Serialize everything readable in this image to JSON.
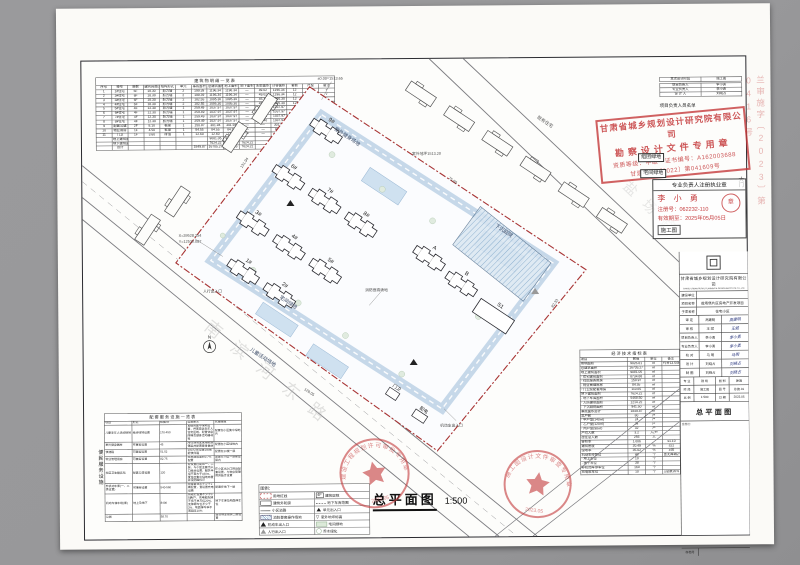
{
  "drawing_title": {
    "name": "总平面图",
    "scale": "1:500"
  },
  "sheet": {
    "margin_stamp": "兰审施字〔2023〕第0416号",
    "gate_label": "大门",
    "box_label_1": "组团绿地",
    "box_label_2": "宅间绿地",
    "fac_category": "便民服务设施",
    "pers_note": "项目负责人员名单",
    "blank_note": "会签栏："
  },
  "buildings_table": {
    "title": "建筑物明细一览表",
    "headers": [
      [
        "序号",
        "楼号",
        "层数",
        "建筑高度(m)",
        "结构形式",
        "单元",
        "基底面积",
        "总建筑面积",
        "地上面积",
        "地下面积",
        "阳台面积",
        "计容面积",
        "套数",
        "户型",
        "备注"
      ]
    ],
    "rows": [
      [
        "1",
        "1#住宅",
        "6F",
        "18.30",
        "剪力墙",
        "2",
        "199.39",
        "1196.34",
        "1196.34",
        "—",
        "49.02",
        "1196.34",
        "12",
        "甲",
        "√"
      ],
      [
        "2",
        "2#住宅",
        "6F",
        "18.30",
        "剪力墙",
        "2",
        "199.39",
        "1196.34",
        "1196.34",
        "—",
        "49.02",
        "1196.34",
        "12",
        "甲",
        "√"
      ],
      [
        "3",
        "3#住宅",
        "6F",
        "18.30",
        "剪力墙",
        "2",
        "182.55",
        "1095.30",
        "1095.30",
        "—",
        "45.15",
        "1095.30",
        "12",
        "乙",
        "√"
      ],
      [
        "4",
        "4#住宅",
        "6F",
        "18.30",
        "剪力墙",
        "2",
        "182.55",
        "1095.30",
        "1095.30",
        "—",
        "45.15",
        "1095.30",
        "12",
        "乙",
        "√"
      ],
      [
        "5",
        "5#住宅",
        "4F",
        "12.30",
        "剪力墙",
        "1",
        "259.49",
        "1037.97",
        "1037.97",
        "—",
        "32.40",
        "1037.97",
        "8",
        "丙",
        "√"
      ],
      [
        "6",
        "6#住宅",
        "4F",
        "12.30",
        "剪力墙",
        "1",
        "259.49",
        "1037.97",
        "1037.97",
        "—",
        "32.40",
        "1037.97",
        "8",
        "丙",
        "√"
      ],
      [
        "7",
        "7#住宅",
        "4F",
        "12.30",
        "剪力墙",
        "1",
        "259.49",
        "1037.97",
        "1037.97",
        "—",
        "32.40",
        "1037.97",
        "8",
        "丙",
        "√"
      ],
      [
        "8",
        "8#住宅",
        "4F",
        "12.30",
        "剪力墙",
        "1",
        "259.49",
        "1037.97",
        "1037.97",
        "—",
        "32.40",
        "1037.97",
        "8",
        "丙",
        "√"
      ],
      [
        "9",
        "配套公建",
        "2F",
        "8.10",
        "框架",
        "1",
        "150.97",
        "301.94",
        "301.94",
        "—",
        "—",
        "301.94",
        "—",
        "—",
        "√"
      ],
      [
        "10",
        "物业用房",
        "1F",
        "4.50",
        "框架",
        "1",
        "84.55",
        "84.55",
        "84.55",
        "—",
        "—",
        "84.55",
        "—",
        "—",
        "√"
      ],
      [
        "11",
        "门卫",
        "1F",
        "3.60",
        "砖混",
        "1",
        "12.60",
        "12.60",
        "12.60",
        "—",
        "—",
        "12.60",
        "—",
        "—",
        "√"
      ],
      [
        "",
        "地上建筑面积小计",
        "",
        "",
        "",
        "",
        "",
        "9081.05",
        "9081.05",
        "",
        "",
        "",
        "",
        "",
        ""
      ],
      [
        "",
        "地下建筑面积",
        "",
        "",
        "",
        "",
        "",
        "7624.22",
        "",
        "7624.22",
        "",
        "",
        "",
        "",
        ""
      ],
      [
        "",
        "合计",
        "",
        "",
        "",
        "",
        "1849.87",
        "16705.27",
        "9081.05",
        "7624.22",
        "",
        "",
        "80",
        "",
        ""
      ]
    ]
  },
  "personnel_table": {
    "stage": [
      [
        "本次设计阶段",
        "施工图"
      ]
    ],
    "rows": [
      [
        "项目负责人",
        "李小勇"
      ],
      [
        "专业负责人",
        "李小勇"
      ],
      [
        "设 计 人",
        "刘晓占"
      ]
    ]
  },
  "stamp_main": {
    "line1": "甘肃省城乡规划设计研究院有限公司",
    "line2": "勘察设计文件专用章",
    "line3": "资质等级：甲级　证书编号：A162003688",
    "line4": "甘建规审〔2022〕第041609号"
  },
  "stamp_reg": {
    "header": "专业负责人注册执业章",
    "name": "李 小 勇",
    "no": "注册号：062232-110",
    "date": "有效期至：2025年05月05日",
    "stage": "施工图",
    "circ": "章"
  },
  "seals": [
    {
      "text": "建设工程规划许可审批专用章",
      "date": "2023.05"
    },
    {
      "text": "施工图设计文件审查专用章",
      "date": "2023.05"
    }
  ],
  "indicators_table": {
    "title": "经济技术指标表",
    "headers": [
      [
        "项目",
        "数值",
        "单位",
        "备注"
      ]
    ],
    "rows": [
      [
        "用地面积",
        "9026.61",
        "㎡",
        "约合13.54亩"
      ],
      [
        "总建筑面积",
        "16705.27",
        "㎡",
        ""
      ],
      [
        "地上建筑面积",
        "9081.05",
        "㎡",
        ""
      ],
      [
        "· 住宅建筑面积",
        "8734.88",
        "㎡",
        ""
      ],
      [
        "· 社区服务用房",
        "150.97",
        "㎡",
        ""
      ],
      [
        "· 物业管理用房",
        "84.55",
        "㎡",
        ""
      ],
      [
        "· 门卫及配套用房",
        "110.65",
        "㎡",
        ""
      ],
      [
        "地下建筑面积",
        "7624.22",
        "㎡",
        ""
      ],
      [
        "· 地下车库面积",
        "5468.50",
        "㎡",
        ""
      ],
      [
        "· 人防建筑面积",
        "1214.22",
        "㎡",
        ""
      ],
      [
        "· 下沉庭院面积",
        "941.50",
        "㎡",
        ""
      ],
      [
        "基底面积总计",
        "1849.87",
        "㎡",
        ""
      ],
      [
        "总户数",
        "80",
        "户",
        ""
      ],
      [
        "· 甲户型(140㎡)",
        "24",
        "户",
        ""
      ],
      [
        "· 乙户型(120㎡)",
        "24",
        "户",
        ""
      ],
      [
        "· 丙户型(98㎡)",
        "32",
        "户",
        ""
      ],
      [
        "户均人数",
        "3.2",
        "人/户",
        ""
      ],
      [
        "居住总人数",
        "256",
        "人",
        ""
      ],
      [
        "容积率",
        "1.006",
        "",
        "≤1.10"
      ],
      [
        "建筑密度",
        "20.49",
        "%",
        "≤22"
      ],
      [
        "绿地率",
        "35.02",
        "%",
        "≥35"
      ],
      [
        "机动车停车位",
        "48",
        "个",
        "含无障碍2个"
      ],
      [
        "· 地上车位",
        "10",
        "个",
        ""
      ],
      [
        "· 地下车位",
        "38",
        "个",
        ""
      ],
      [
        "非机动车停车位",
        "160",
        "个",
        ""
      ],
      [
        "充电桩车位",
        "10",
        "个",
        "≥总数20%"
      ]
    ]
  },
  "facilities_table": {
    "title": "配套服务设施一览表",
    "headers": [
      [
        "项目",
        "形式",
        "规模/㎡",
        "设置要求",
        "实施措施"
      ]
    ],
    "rows": [
      [
        "儿童老年人活动场地",
        "结合绿地设置",
        "170-450",
        "宜结合集中绿地设置，并宜靠近老年人住宅区域，配置休息座椅及健身活动器材等",
        "配置在小区集中绿地内"
      ],
      [
        "室外健身器材",
        "可兼容设置",
        "45",
        "所在场地宜采用软质铺装并配置健身器材",
        "配置在小区绿地内"
      ],
      [
        "快递箱",
        "可兼容设置",
        "51.52",
        "100人/处设置1处智能快件箱",
        "配置在1#楼一层"
      ],
      [
        "物业管理用房",
        "可兼容设置",
        "82.75",
        "按总建筑面积0.7%配置",
        "配置在小区一层架空层内"
      ],
      [
        "社区卫生服务站",
        "配套公建设置",
        "120",
        "应设置在建筑一、二层，与小区主要出入口结合设置，服务半径不宜大于150m，宜结合集中绿地布置并设明显标识",
        "在小区出入口附近配套设置，与物业管理用房结合设置"
      ],
      [
        "非机动车库(一、二类设置)",
        "可兼容设置",
        "540-560",
        "按每套住宅不少于2辆配置，宜设置充电设施",
        "配置在地下一层"
      ],
      [
        "机动车停车场(库)",
        "地上及地下",
        "8400",
        "按规范设置不少于0.5辆/户，充电桩配建不低于总车位20%，无障碍车位不少于2%，地面停车率不宜超过10%",
        "地下车库及地面停车位"
      ],
      [
        "公厕",
        "",
        "58.70",
        "",
        "结合物业用房二层设置"
      ]
    ]
  },
  "legend": {
    "title": "图例：",
    "left": [
      {
        "label": "用地红线"
      },
      {
        "label": "建筑外轮廓"
      },
      {
        "label": "小区道路"
      },
      {
        "label": "消防登高操作场地"
      },
      {
        "label": "机动车出入口"
      },
      {
        "label": "人行出入口"
      }
    ],
    "right": [
      {
        "label": "建筑层数",
        "swatch_text": "4F"
      },
      {
        "label": "地下车库范围"
      },
      {
        "label": "单元出入口"
      },
      {
        "label": "室外地坪标高",
        "swatch_text": "▽"
      },
      {
        "label": "宅间绿地"
      },
      {
        "label": "乔木绿化"
      }
    ]
  },
  "title_block": {
    "company": "甘肃省城乡规划设计研究院有限公司",
    "company_en": "GANSU URBAN-RURAL PLANNING & DESIGN INSTITUTE CO.,LTD",
    "fields": [
      {
        "label": "建设单位",
        "value": ""
      },
      {
        "label": "项目名称",
        "value": "盐场堡片区房地产开发项目"
      },
      {
        "label": "子项名称",
        "value": "住宅小区"
      }
    ],
    "staff": [
      {
        "label": "审 定",
        "name": "高建明",
        "sig": "高建明"
      },
      {
        "label": "审 核",
        "name": "王 斌",
        "sig": "王斌"
      },
      {
        "label": "项目负责人",
        "name": "李小勇",
        "sig": "李小勇"
      },
      {
        "label": "专业负责人",
        "name": "李小勇",
        "sig": "李小勇"
      },
      {
        "label": "校 对",
        "name": "马 明",
        "sig": "马明"
      },
      {
        "label": "设 计",
        "name": "刘晓占",
        "sig": "刘晓占"
      },
      {
        "label": "制 图",
        "name": "刘晓占",
        "sig": "刘晓占"
      }
    ],
    "meta": [
      {
        "l1": "专 业",
        "v1": "建 筑",
        "l2": "图 别",
        "v2": "建施"
      },
      {
        "l1": "阶 段",
        "v1": "施工图",
        "l2": "图 号",
        "v2": "总施-01"
      },
      {
        "l1": "比 例",
        "v1": "1:500",
        "l2": "日 期",
        "v2": "2023.05"
      }
    ],
    "sheet_name": "总平面图",
    "archive_label": "存档号",
    "archive_value": ""
  },
  "plan": {
    "buildings": [
      "1#",
      "2#",
      "3#",
      "4#",
      "5#",
      "6#",
      "7#",
      "8#",
      "9#",
      "A",
      "B",
      "S1"
    ],
    "small_buildings": [
      "门卫",
      "配电"
    ],
    "labels": {
      "fitness": "室外健身场地",
      "sunken": "下沉庭院",
      "green": "宅间绿地",
      "kids": "儿童活动场地"
    },
    "road_names": {
      "south": "南滨河东路",
      "east": "盐场路"
    },
    "north": "N",
    "annotations": [
      "X=39528.354",
      "Y=12530.087",
      "±0.00=1513.65",
      "室外地坪1513.20",
      "消防登高场地",
      "机动车出入口",
      "人行出入口",
      "131.94",
      "75.60",
      "128.05",
      "82.33",
      "既有住宅"
    ]
  }
}
